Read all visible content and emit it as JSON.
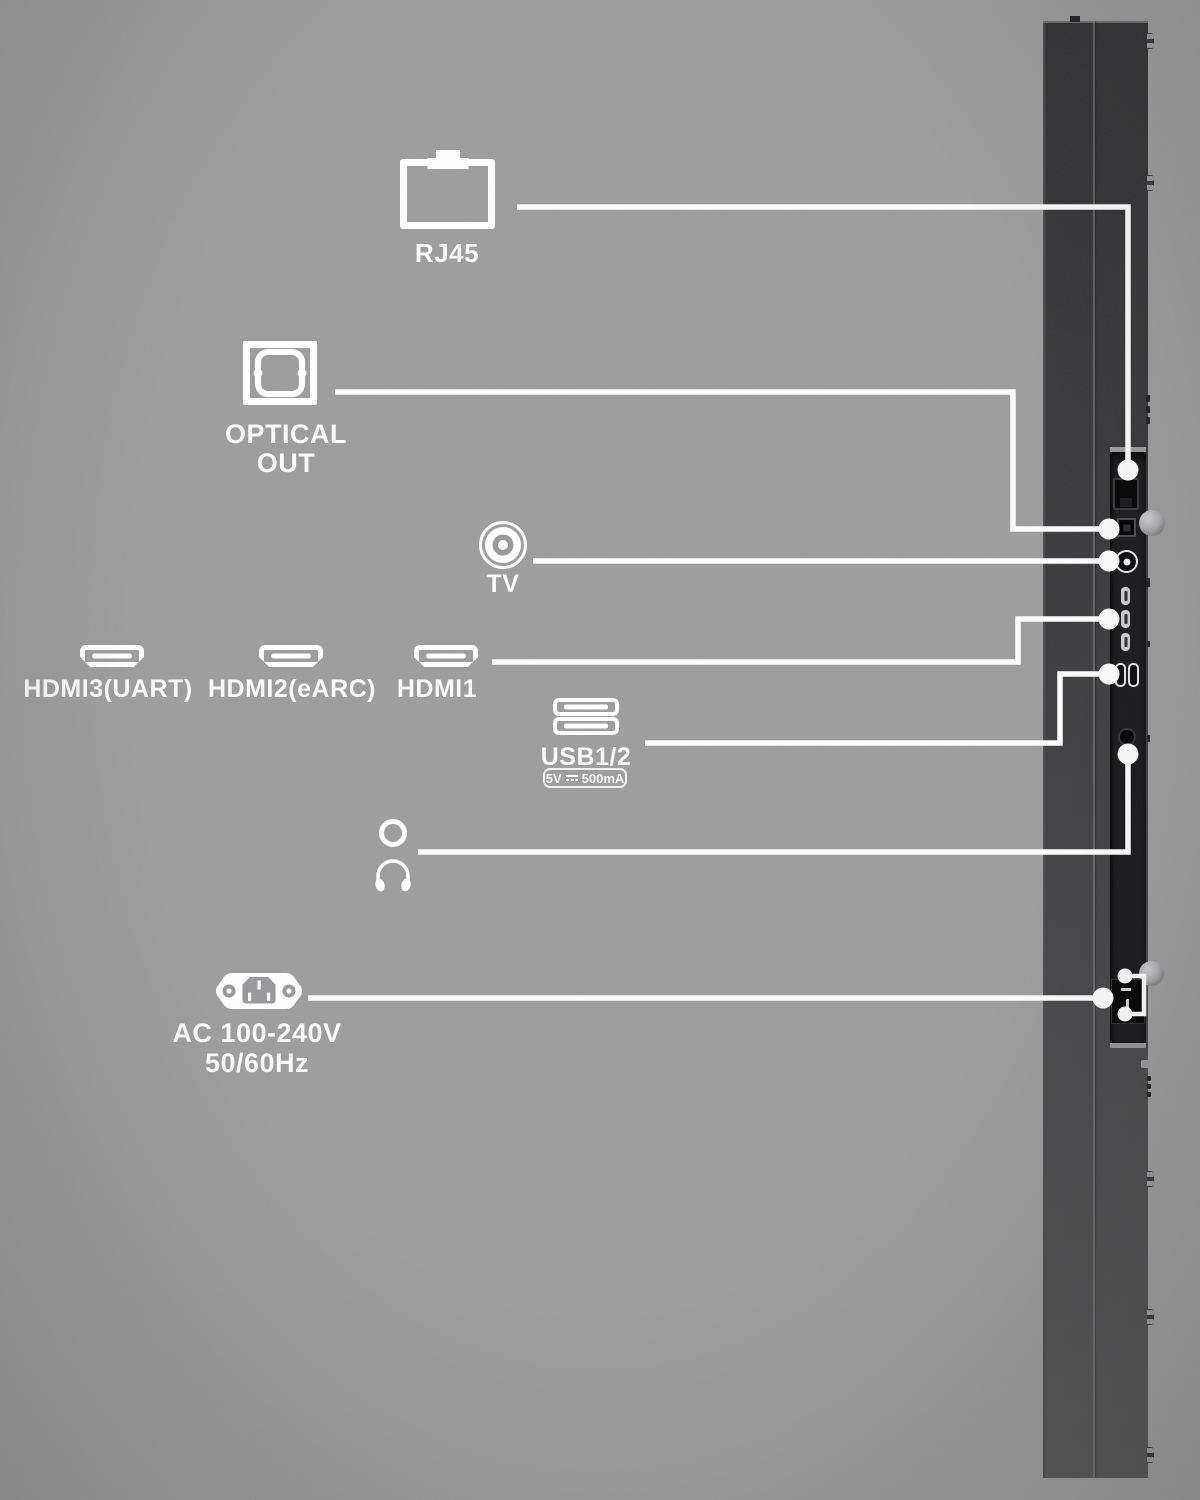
{
  "colors": {
    "background": "#9b9b9b",
    "connector_line": "#ffffff",
    "tv_body_dark": "#323234",
    "tv_body_light": "#565658",
    "port_panel": "#1c1c1e",
    "label_text": "#fbfbfb"
  },
  "callouts": {
    "rj45": {
      "label": "RJ45"
    },
    "optical_out": {
      "line1": "OPTICAL",
      "line2": "OUT"
    },
    "tv_antenna": {
      "label": "TV"
    },
    "hdmi3": {
      "label": "HDMI3(UART)"
    },
    "hdmi2": {
      "label": "HDMI2(eARC)"
    },
    "hdmi1": {
      "label": "HDMI1"
    },
    "usb": {
      "label": "USB1/2",
      "badge_voltage": "5V",
      "badge_current": "500mA"
    },
    "ac_power": {
      "line1": "AC 100-240V",
      "line2": "50/60Hz"
    }
  }
}
